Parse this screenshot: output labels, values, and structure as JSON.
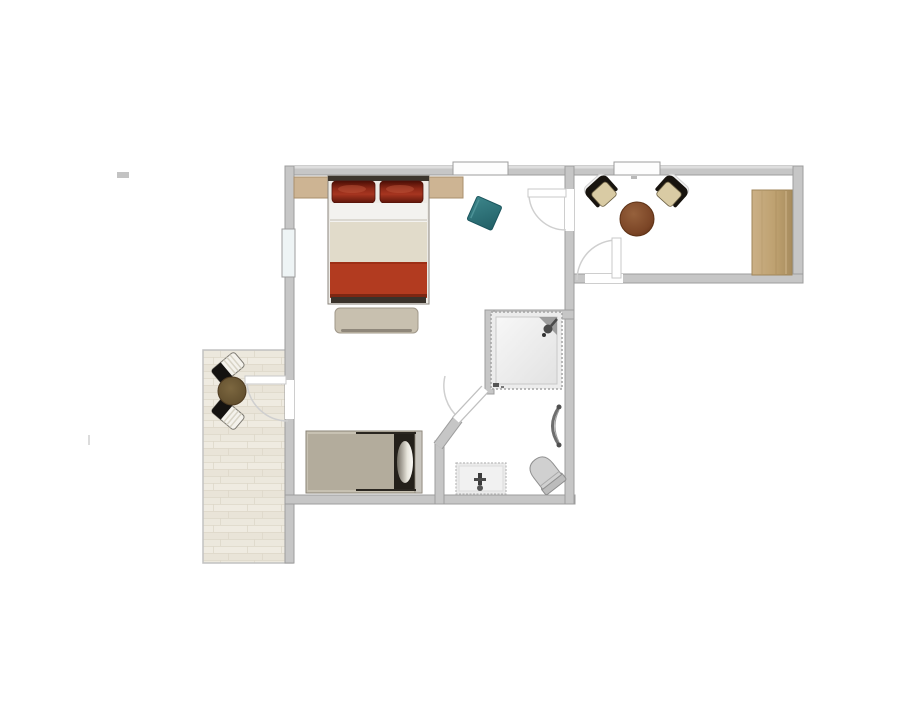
{
  "figure": {
    "kind": "floor-plan",
    "description": "Top-down architectural floor plan of a small apartment: bedroom with double bed, hallway sitting area, bathroom, and terrace. No visible text labels.",
    "background": "#ffffff",
    "visible_text_items": []
  },
  "colors": {
    "wall": "#c6c6c6",
    "wall_border": "#9d9d9d",
    "wall_highlight": "#dedede",
    "door_arc": "#cfcfcf",
    "terrace_floor": "#ece7dc",
    "plank_seam": "#ded8c9",
    "nightstand_wood": "#cdb493",
    "wardrobe_wood": "#bda06f",
    "pillow_red": "#8f2917",
    "blanket_red": "#b23b20",
    "blanket_beige": "#e1dbca",
    "sheet_white": "#f3f2ef",
    "bench_beige": "#c8c0af",
    "teal": "#2d777d",
    "table_brown": "#7b4526",
    "terrace_table_brown": "#6a5433",
    "chair_cushion": "#d9cba4",
    "chair_black": "#18140f",
    "daybed_gray": "#b3ac9c",
    "frame_dark": "#24201a",
    "fixture_gray": "#d0d0d0",
    "fixture_border": "#909090"
  },
  "plan": {
    "rooms": [
      {
        "name": "bedroom",
        "furniture": [
          {
            "item": "double-bed",
            "color": "#b23b20"
          },
          {
            "item": "nightstand-left",
            "color": "#cdb493"
          },
          {
            "item": "nightstand-right",
            "color": "#cdb493"
          },
          {
            "item": "bed-bench",
            "color": "#c8c0af"
          },
          {
            "item": "teal-pouf",
            "color": "#2d777d"
          },
          {
            "item": "daybed",
            "color": "#b3ac9c"
          }
        ]
      },
      {
        "name": "hallway",
        "furniture": [
          {
            "item": "armchair-left",
            "color": "#d9cba4"
          },
          {
            "item": "armchair-right",
            "color": "#d9cba4"
          },
          {
            "item": "round-side-table",
            "color": "#7b4526"
          },
          {
            "item": "wardrobe",
            "color": "#bda06f"
          }
        ]
      },
      {
        "name": "bathroom",
        "furniture": [
          {
            "item": "shower",
            "color": "#ececec"
          },
          {
            "item": "towel-radiator",
            "color": "#6e6e6e"
          },
          {
            "item": "toilet",
            "color": "#d0d0d0"
          },
          {
            "item": "sink-vanity",
            "color": "#ebebeb"
          }
        ]
      },
      {
        "name": "terrace",
        "furniture": [
          {
            "item": "bistro-table",
            "color": "#6a5433"
          },
          {
            "item": "terrace-chair-top",
            "color": "#141210"
          },
          {
            "item": "terrace-chair-bottom",
            "color": "#141210"
          }
        ]
      }
    ],
    "openings": {
      "windows": 3,
      "doors": 4
    }
  }
}
